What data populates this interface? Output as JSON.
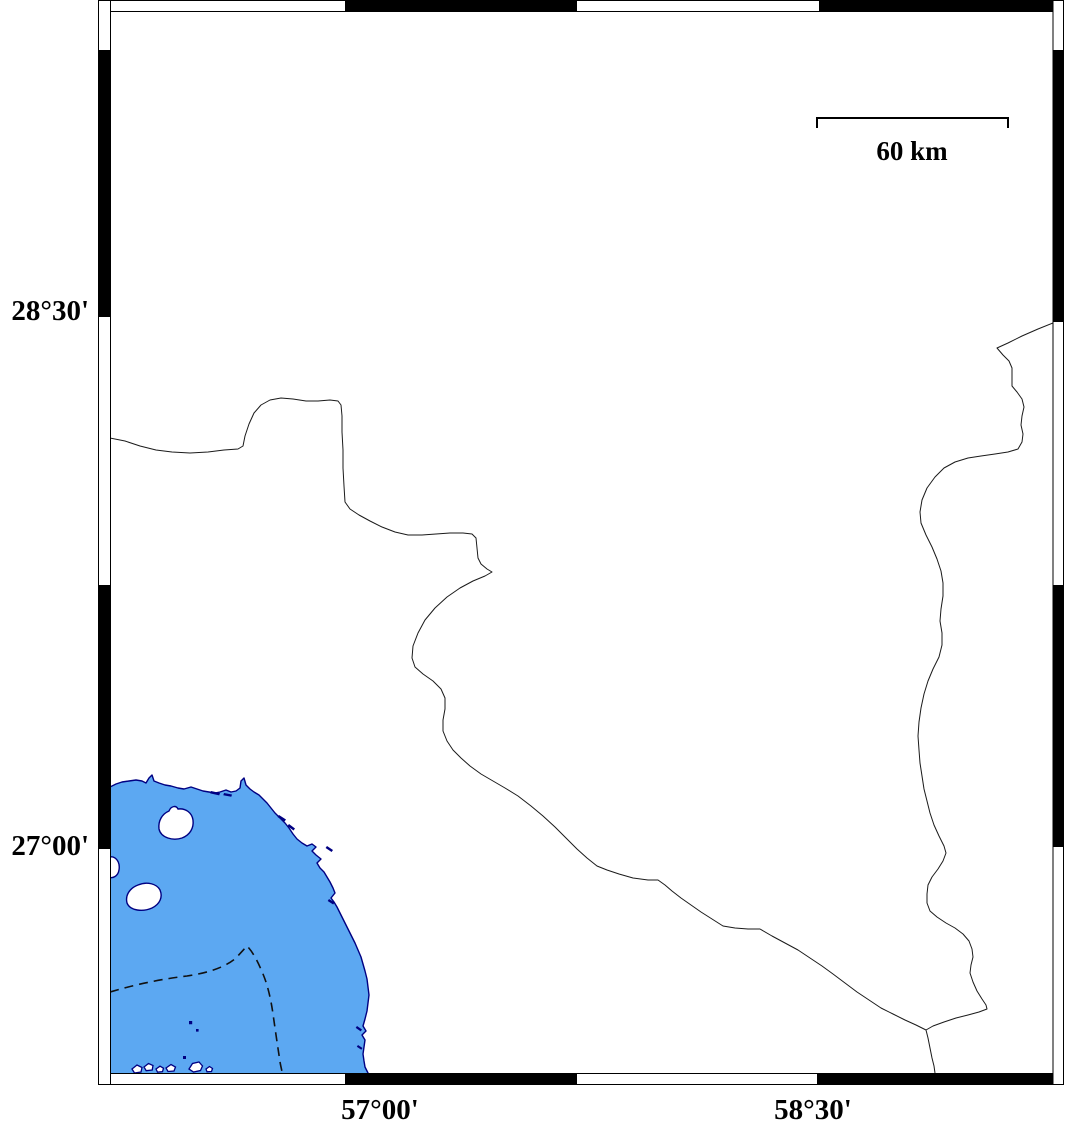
{
  "labels": {
    "lat_top": "28°30'",
    "lat_bottom": "27°00'",
    "lon_left": "57°00'",
    "lon_right": "58°30'"
  },
  "scalebar": {
    "label": "60 km"
  },
  "colors": {
    "sea_fill": "#5CA8F2",
    "coast_stroke": "#000082",
    "land_fill": "#ffffff",
    "border_stroke": "#1a1a1a",
    "contour_stroke": "#111111",
    "frame_stroke": "#000000",
    "frame_black": "#000000",
    "frame_white": "#ffffff"
  },
  "geometry": {
    "clip_rect": {
      "x": "110.5",
      "y": "11.5",
      "w": "942.5",
      "h": "1062"
    },
    "sea_path": "M110,787 L116,784 122,782 129,781 136,780 142,781 146,783 149,778 152,775 154,781 159,783 165,785 171,786 178,788 184,789 191,787 197,789 203,791 209,792 215,793 220,792 226,790 231,792 236,791 240,788 241,781 244,778 246,785 250,789 254,792 259,795 263,799 267,803 271,808 275,813 280,818 285,823 289,828 293,834 297,839 302,843 307,846 312,844 316,847 312,851 316,855 321,859 317,863 320,868 324,872 327,877 330,882 333,888 335,893 331,898 334,902 337,907 340,913 343,919 346,925 349,931 352,937 355,943 358,950 361,957 363,964 365,971 367,979 368,987 369,995 368,1003 367,1011 365,1019 363,1026 366,1031 362,1035 365,1040 364,1047 363,1054 364,1061 365,1067 368,1073 368,1077 110,1077 Z",
    "islands": [
      "M159,829 C158,821 162,814 169,811 C171,806 176,805 178,809 C186,808 192,813 193,820 C194,828 190,835 182,838 C173,841 161,838 159,829 Z",
      "M104,867 C104,860 108,856 113,857 C118,859 120,864 119,870 C118,876 113,879 108,877 C105,875 104,871 104,867 Z",
      "M127,903 C125,895 130,888 138,885 C147,881 157,884 160,890 C163,897 160,904 152,908 C143,912 130,911 127,903 Z"
    ],
    "islet_cluster": "M132,1069 l5,-4 5,2.5 -1,4.5 -6.5,1 Z M144,1067 l4.5,-3.5 4.5,2 -0.8,4.5 -6,0.7 Z M156,1069 l4,-2.8 3.5,2 -1,3.5 -5,0.5 Z M166,1068 l5,-3.5 4.5,2.5 -1.5,4 -6,0.5 Z M189,1069 l3.5,-5.5 6.5,-1.5 3.5,4 -2,4.5 -7,1.5 Z M206,1069 l3.5,-2.5 3,2 -1,3 -4.5,0.3 Z",
    "coastal_dashes": "M211,791 l9,2 -0.8,2.4 -9,-2 Z M224,793 l8,1.5 -0.7,2.3 -8,-1.5 Z M279,815 l7,4.5 -1.5,2 -7,-4.5 Z M289,824 l6,4.5 -1.5,2 -6,-4.5 Z M327,846 l6,4 -1.4,2 -6,-4 Z M329,899 l5.5,3.5 -1.3,2 -5.5,-3.5 Z M357,1026 l5,3.5 -1.3,1.9 -5,-3.5 Z M358,1045 l4.5,3 -1.2,1.8 -4.5,-3 Z",
    "sea_dots": "M189,1021 h3.2 v3.2 h-3.2 Z M196,1029 h2.6 v2.6 h-2.6 Z M183,1056 h3 v3 h-3 Z",
    "contour_path": "M110,992 C137,984 162,979 187,976 C207,973 224,968 236,958 L247,946 C253,952 258,962 263,974 C268,986 271,1000 273,1014 C275,1028 277,1042 279,1055 C280,1064 282,1071 283,1076",
    "border_west": "M110,438 L125,441 140,446 156,450 172,452 190,453 208,452 224,450 238,449 243,446 245,436 249,424 254,413 261,405 270,400 281,398 293,399 306,401 318,401 330,400 338,401 341,405 342,416 342,432 343,450 343,468 344,486 345,502 350,509 359,515 370,521 382,527 395,532 408,535 422,535 436,534 450,533 463,533 472,534 476,538 477,548 478,558 481,564 487,569 492,572 485,576 473,581 460,588 447,597 435,608 425,620 418,633 413,646 412,658 415,667 423,674 433,681 441,689 445,698 445,709 443,720 443,731 447,741 453,750 461,758 470,766 481,774 493,781 505,788 518,796 531,806 543,816 555,827 566,838 577,849 587,858 597,866 607,870 619,874 633,878 648,880 658,880 665,885 672,891 681,898 691,905 701,912 712,919 723,926 735,928 748,929 760,929 772,936 785,943 798,950 810,958 822,966 833,974 845,983 857,992 869,1000 881,1008 893,1014 905,1020 916,1025 926,1030",
    "border_east": "M1053,323 L1038,329 1022,336 1008,343 997,348 1003,355 1009,361 1012,368 1012,377 1012,386 1017,392 1022,399 1024,407 1022,416 1021,425 1023,434 1022,442 1018,449 1008,452 995,454 981,456 968,458 955,462 944,468 935,477 927,488 922,500 920,512 921,523 926,535 932,547 937,559 941,571 943,583 943,596 941,609 940,621 942,633 942,645 939,657 933,669 928,681 924,694 921,708 919,722 918,736 919,750 920,763 922,776 924,789 927,801 930,813 934,825 939,836 944,846 946,853 943,861 938,869 932,877 928,885 927,894 927,903 930,911 937,917 946,923 955,928 963,934 969,941 972,949 973,957 971,965 970,973 973,982 977,991 982,999 986,1005 987,1009 979,1012 968,1015 956,1018 944,1022 933,1026 926,1030 928,1038 930,1048 932,1058 934,1066 935,1073",
    "frame_black_segments": "M345,0.5 h232 v11 h-232 Z M819,0.5 h234 v11 h-234 Z M345,1073.5 h232 v11 h-232 Z M817,1073.5 h236 v11 h-236 Z M98.5,50 h12 v267 h-12 Z M98.5,585 h12 v264 h-12 Z M1053,50 h10.5 v272 h-10.5 Z M1053,585 h10.5 v262 h-10.5 Z",
    "scalebar_path": "M817,128 L817,118 L1008,118 L1008,128"
  }
}
